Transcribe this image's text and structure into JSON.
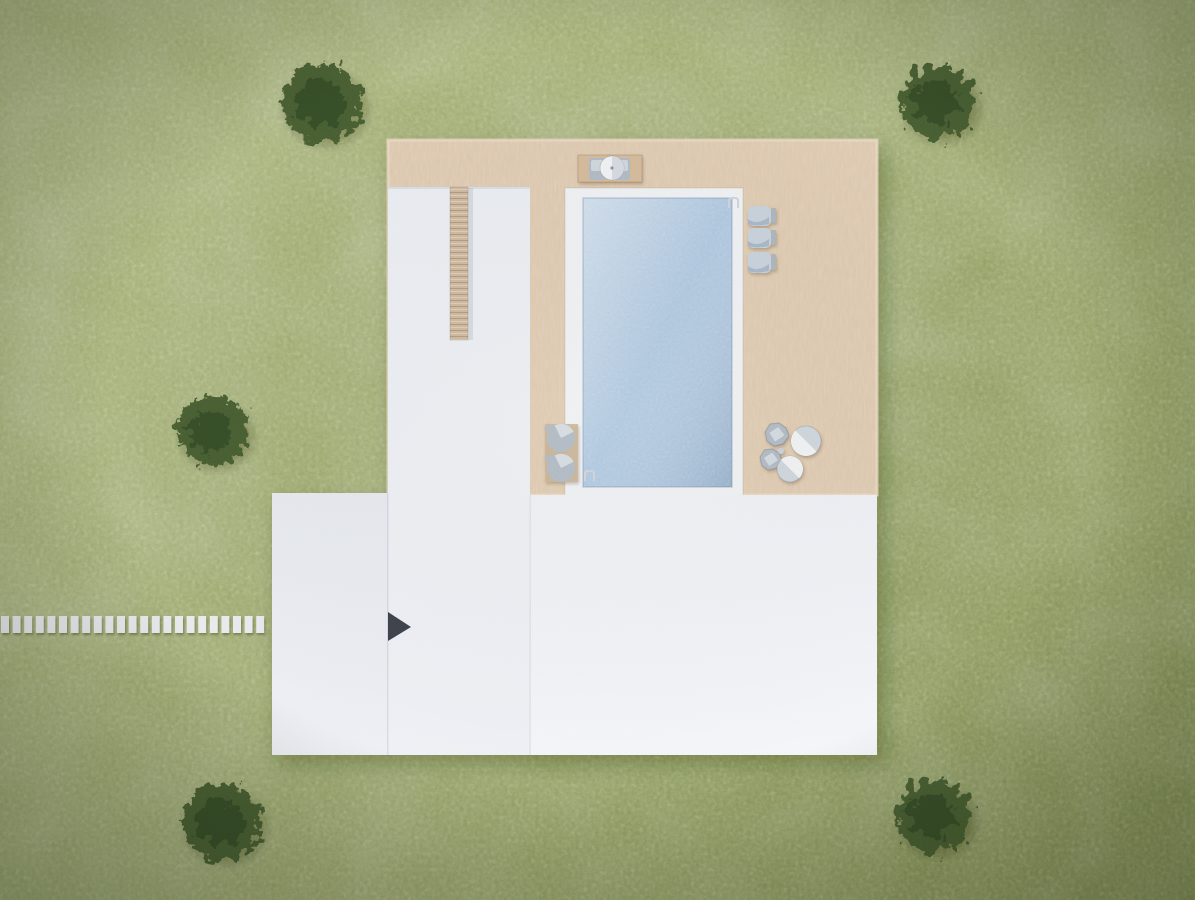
{
  "scene": {
    "canvas": {
      "width": 1195,
      "height": 900
    }
  },
  "colors": {
    "grass_light": "#a3af72",
    "grass_base": "#93a166",
    "grass_dark": "#76854e",
    "tree_foliage": "#45592f",
    "tree_core": "#344823",
    "deck_wood": "#dcc6ab",
    "deck_wood_edge": "#e8d7c0",
    "roof_center": "#e9ecf1",
    "roof_center_b": "#eef0f5",
    "roof_left": "#e5e8ee",
    "roof_left_b": "#edeff4",
    "roof_main": "#edeff4",
    "roof_main_b": "#f4f5f9",
    "chimney_brick": "#cdb69b",
    "pool_coping": "#eef0f3",
    "pool_water": "#a9c3dd",
    "paver_white": "#e7eaec",
    "vent_dark": "#3c4149",
    "furniture_gray": "#aeb8c3",
    "furniture_light": "#d5dbe1",
    "furniture_cushion": "#c6d0da",
    "furniture_shade": "#9db0c2",
    "furniture_frame": "#aab2bb",
    "table_shade": "#ccd4db",
    "lounger_mat": "#c9b193",
    "umbrella_white": "#f0f1f3",
    "umbrella_shade": "#d3d9df",
    "bench_platform": "#d2b896",
    "ladder_metal": "#cdd2d9"
  },
  "objects": {
    "trees": [
      {
        "cx": 322,
        "cy": 103,
        "r": 40
      },
      {
        "cx": 938,
        "cy": 102,
        "r": 37
      },
      {
        "cx": 213,
        "cy": 431,
        "r": 35
      },
      {
        "cx": 222,
        "cy": 822,
        "r": 39
      },
      {
        "cx": 934,
        "cy": 816,
        "r": 37
      }
    ],
    "path": {
      "y": 616,
      "height": 17,
      "x_start": 1,
      "count": 23,
      "pitch": 11.6,
      "paver_width": 8
    },
    "deck": {
      "x": 388,
      "y": 140,
      "width": 489,
      "height": 355
    },
    "roofs": {
      "center_wing": {
        "x": 388,
        "y": 187,
        "width": 142,
        "height": 568
      },
      "left_wing": {
        "x": 272,
        "y": 493,
        "width": 116,
        "height": 262
      },
      "main": {
        "x": 530,
        "y": 495,
        "width": 347,
        "height": 260
      }
    },
    "chimney": {
      "x": 450,
      "y": 187,
      "width": 18,
      "height": 153
    },
    "roof_vent_triangle": {
      "points": "388,612 411,627 388,641"
    },
    "pool": {
      "coping": {
        "x": 565,
        "y": 188,
        "width": 178,
        "height": 309
      },
      "water": {
        "x": 583,
        "y": 198,
        "width": 149,
        "height": 289
      }
    },
    "umbrella_table": {
      "platform": {
        "x": 578,
        "y": 155,
        "width": 64,
        "height": 27
      },
      "chairs": [
        {
          "x": 589,
          "y": 158,
          "width": 17,
          "height": 22
        },
        {
          "x": 613,
          "y": 158,
          "width": 17,
          "height": 22
        }
      ],
      "umbrella": {
        "cx": 612,
        "cy": 168,
        "r": 12
      }
    },
    "right_loungers": [
      {
        "x": 748,
        "y": 206,
        "width": 28,
        "height": 20
      },
      {
        "x": 748,
        "y": 228,
        "width": 28,
        "height": 20
      },
      {
        "x": 748,
        "y": 252,
        "width": 28,
        "height": 21
      }
    ],
    "left_lounger_mat": {
      "x": 545,
      "y": 424,
      "width": 33,
      "height": 58
    },
    "left_loungers": [
      {
        "cx": 561,
        "cy": 438,
        "r": 14
      },
      {
        "cx": 561,
        "cy": 468,
        "r": 14
      }
    ],
    "dining_set": {
      "tables": [
        {
          "cx": 806,
          "cy": 441,
          "r": 15
        },
        {
          "cx": 790,
          "cy": 469,
          "r": 13
        }
      ],
      "chairs": [
        {
          "cx": 777,
          "cy": 434,
          "r": 12
        },
        {
          "cx": 771,
          "cy": 459,
          "r": 11
        }
      ]
    }
  }
}
